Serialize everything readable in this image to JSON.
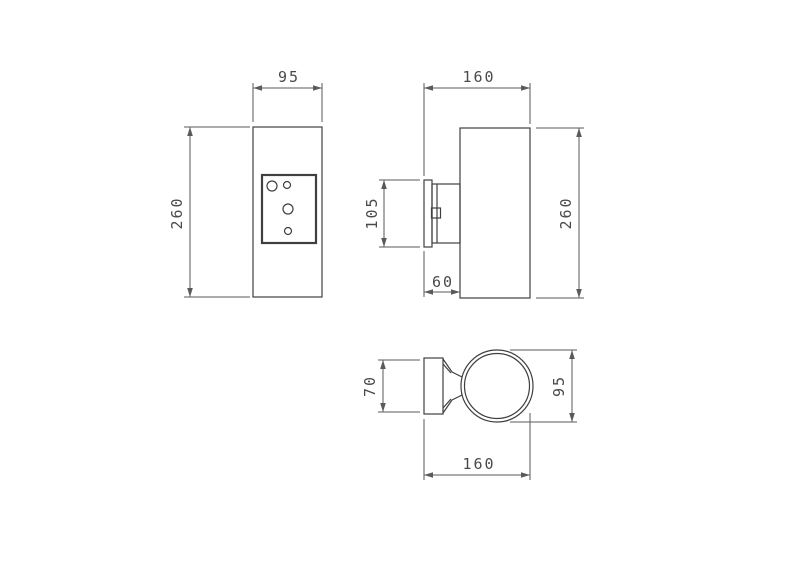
{
  "colors": {
    "line": "#3f3f3f",
    "dimension": "#5a5a5a",
    "background": "#ffffff"
  },
  "views": {
    "front": {
      "width": "95",
      "height": "260"
    },
    "side": {
      "width": "160",
      "height": "260",
      "bracket_height": "105",
      "bracket_depth": "60"
    },
    "bottom": {
      "bracket_width": "70",
      "body_diameter": "95",
      "depth": "160"
    }
  }
}
